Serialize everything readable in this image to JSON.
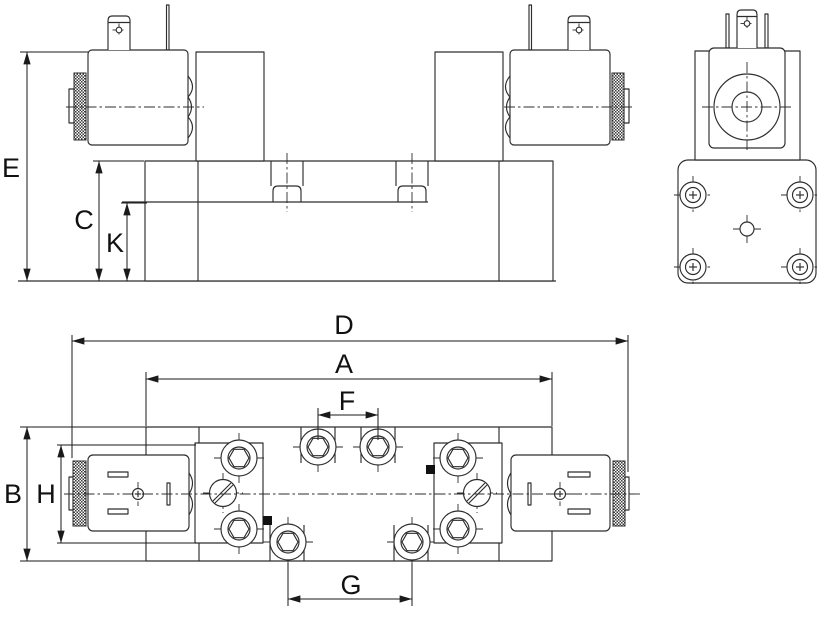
{
  "drawing": {
    "background_color": "#ffffff",
    "line_color": "#2d2d2d",
    "label_color": "#111111",
    "dimension_labels": {
      "E": "E",
      "C": "C",
      "K": "K",
      "D": "D",
      "A": "A",
      "F": "F",
      "G": "G",
      "B": "B",
      "H": "H"
    }
  }
}
